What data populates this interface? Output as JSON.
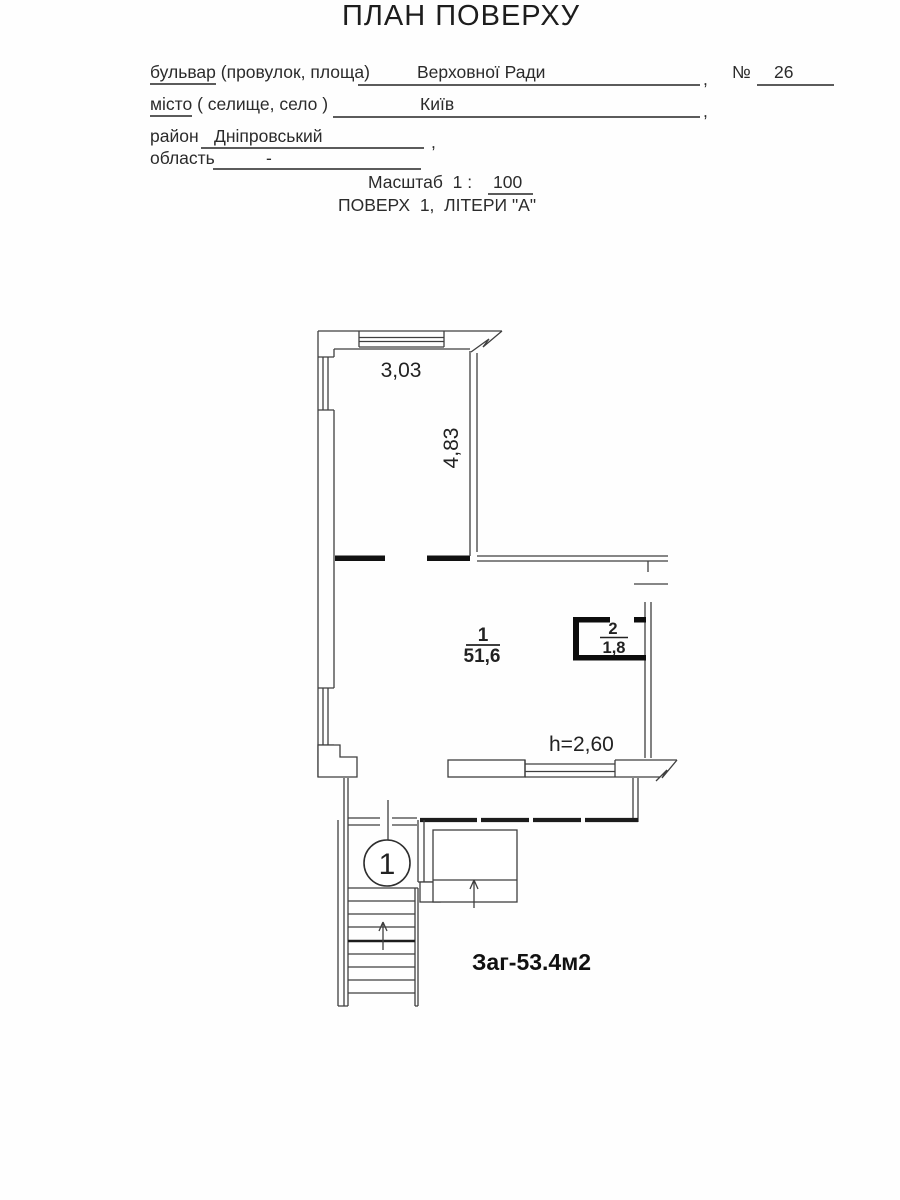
{
  "header": {
    "title": "ПЛАН ПОВЕРХУ"
  },
  "form": {
    "street": {
      "label_main": "бульвар",
      "label_rest": " (провулок, площа)",
      "value": "Верховної Ради",
      "comma": ",",
      "number_sign": "№",
      "number": "26"
    },
    "city": {
      "label_main": "місто",
      "label_rest": " ( селище, село )",
      "value": "Київ",
      "comma": ","
    },
    "district": {
      "label": "район",
      "value": "Дніпровський",
      "comma": ","
    },
    "region": {
      "label": "область",
      "value": "-"
    },
    "scale": {
      "label": "Масштаб  1 :",
      "value": "100"
    },
    "floor_line": "ПОВЕРХ  1,  ЛІТЕРИ \"А\""
  },
  "plan": {
    "dim_width": "3,03",
    "dim_height": "4,83",
    "room1": {
      "number": "1",
      "area": "51,6"
    },
    "room2": {
      "number": "2",
      "area": "1,8"
    },
    "ceiling_height": "h=2,60",
    "entrance_number": "1",
    "total_area": "Заг-53.4м2"
  },
  "colors": {
    "line": "#3f3f3f",
    "wall": "#101010",
    "text": "#262626"
  }
}
